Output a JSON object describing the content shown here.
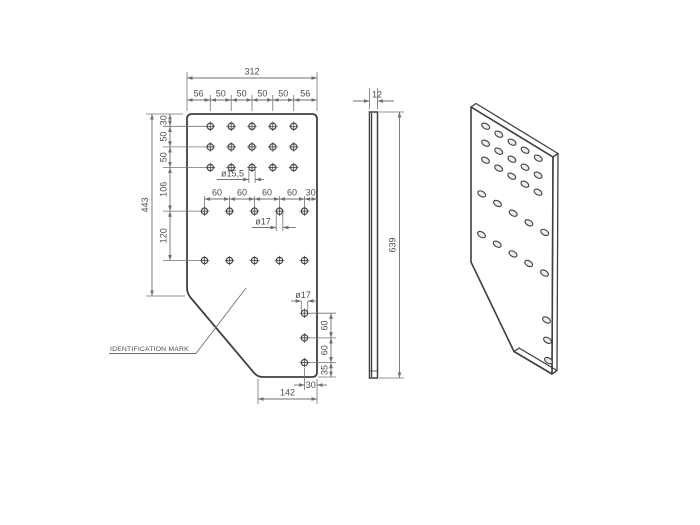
{
  "title": "plate-technical-drawing",
  "colors": {
    "background": "#ffffff",
    "plate": "#c5c7c6",
    "outline": "#3d4140",
    "dim_line": "#6e7170",
    "dim_text": "#4b4f4e",
    "hole_fill": "#e9eae9",
    "iso_top_face": "#8f9392",
    "iso_side_face": "#a2a5a4",
    "iso_bottom_face": "#c0c2c1"
  },
  "front_view": {
    "overall_width": "312",
    "top_chain": [
      "56",
      "50",
      "50",
      "50",
      "50",
      "56"
    ],
    "overall_height": "443",
    "left_chain": [
      "30",
      "50",
      "50",
      "106",
      "120"
    ],
    "row4_chain": [
      "60",
      "60",
      "60",
      "60",
      "30"
    ],
    "callout_small_hole": "ø15,5",
    "callout_mid_hole": "ø17",
    "callout_bottom_hole": "ø17",
    "right_chain": [
      "60",
      "60",
      "35"
    ],
    "edge_offset": "30",
    "bottom_width": "142",
    "identification_label": "IDENTIFICATION MARK"
  },
  "side_view": {
    "thickness": "12",
    "height": "639"
  }
}
